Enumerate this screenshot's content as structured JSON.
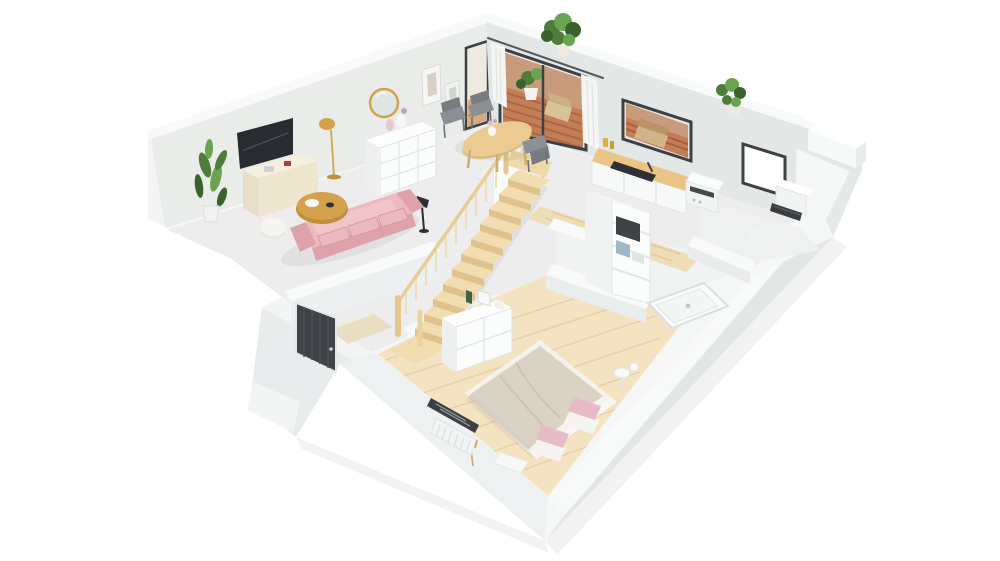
{
  "canvas": {
    "width": 1000,
    "height": 561,
    "background": "#ffffff"
  },
  "scene": {
    "view": "isometric-dollhouse-3d-floor-plan",
    "rooms": [
      {
        "name": "living-room",
        "furniture": [
          "wall-tv",
          "media-unit",
          "floor-lamp-gold",
          "corner-plant",
          "pink-sofa",
          "gold-coffee-table",
          "white-pouf",
          "round-gold-mirror",
          "picture-frames",
          "white-dresser",
          "black-floor-lamp"
        ]
      },
      {
        "name": "dining-area",
        "furniture": [
          "oval-wood-table",
          "gray-chairs",
          "flower-vase"
        ]
      },
      {
        "name": "terrace",
        "furniture": [
          "wood-deck",
          "potted-plant",
          "outdoor-lounge"
        ]
      },
      {
        "name": "kitchen",
        "furniture": [
          "wood-counter",
          "dark-cooktop-sink",
          "faucet",
          "window"
        ]
      },
      {
        "name": "utility-corner",
        "furniture": [
          "washing-machine"
        ]
      },
      {
        "name": "bathroom",
        "furniture": [
          "bookshelf",
          "shower-tray"
        ]
      },
      {
        "name": "right-room",
        "furniture": [
          "bright-window",
          "white-cabinet",
          "dark-heater"
        ]
      },
      {
        "name": "staircase",
        "furniture": [
          "wood-steps",
          "balustrade",
          "newel-posts",
          "white-column"
        ]
      },
      {
        "name": "entry",
        "furniture": [
          "dark-front-door",
          "door-mat",
          "outside-step"
        ]
      },
      {
        "name": "bedroom",
        "furniture": [
          "double-bed",
          "pink-pillows",
          "white-dresser",
          "radiator-window",
          "side-table",
          "gold-lamp",
          "white-bench"
        ]
      }
    ],
    "wall_top_plants": 2
  },
  "palette": {
    "wall_top": "#f8f9f9",
    "wall_face": "#e9ece9",
    "wall_outer": "#f3f5f5",
    "slab_face": "#e2e6e7",
    "floor_main": "#ededee",
    "floor_bath": "#f1f2f2",
    "floor_wood": "#f3e3c1",
    "floor_wood_line": "#e3d0a6",
    "hall_wood": "#eeddb6",
    "deck_wood": "#c47e57",
    "deck_wood_dark": "#a8613c",
    "deck_wall": "#c99b7d",
    "stair_wood": "#f2ddb0",
    "stair_riser": "#e0c28e",
    "rail_wood": "#e8cd98",
    "baluster_wood": "#efddb6",
    "frame_dark": "#3d4145",
    "door_dark": "#3f4347",
    "glass_white": "#ffffff",
    "sofa_pink": "#ecb9be",
    "sofa_pink_deep": "#dfa2ab",
    "sofa_pink_light": "#f1c6ca",
    "gold": "#d5a14d",
    "gold_deep": "#c08f3a",
    "tv_screen": "#282b30",
    "cream": "#f5efe0",
    "cream_deep": "#eee5cf",
    "table_wood": "#eccb92",
    "table_wood_deep": "#d9b678",
    "chair_gray": "#8b9095",
    "chair_gray_deep": "#777c81",
    "counter_wood": "#eac585",
    "cooktop": "#2e3237",
    "appliance_white": "#f2f4f4",
    "duvet": "#d9d2c5",
    "duvet_shade": "#c9c1b2",
    "pillow_pink": "#e7bcc6",
    "linen_white": "#f5f4f1",
    "plant_green": "#4e7d3b",
    "plant_green_light": "#6aa351",
    "plant_green_dark": "#3a622c",
    "radiator_dark": "#3a3e42",
    "lamp_black": "#2d3034"
  }
}
